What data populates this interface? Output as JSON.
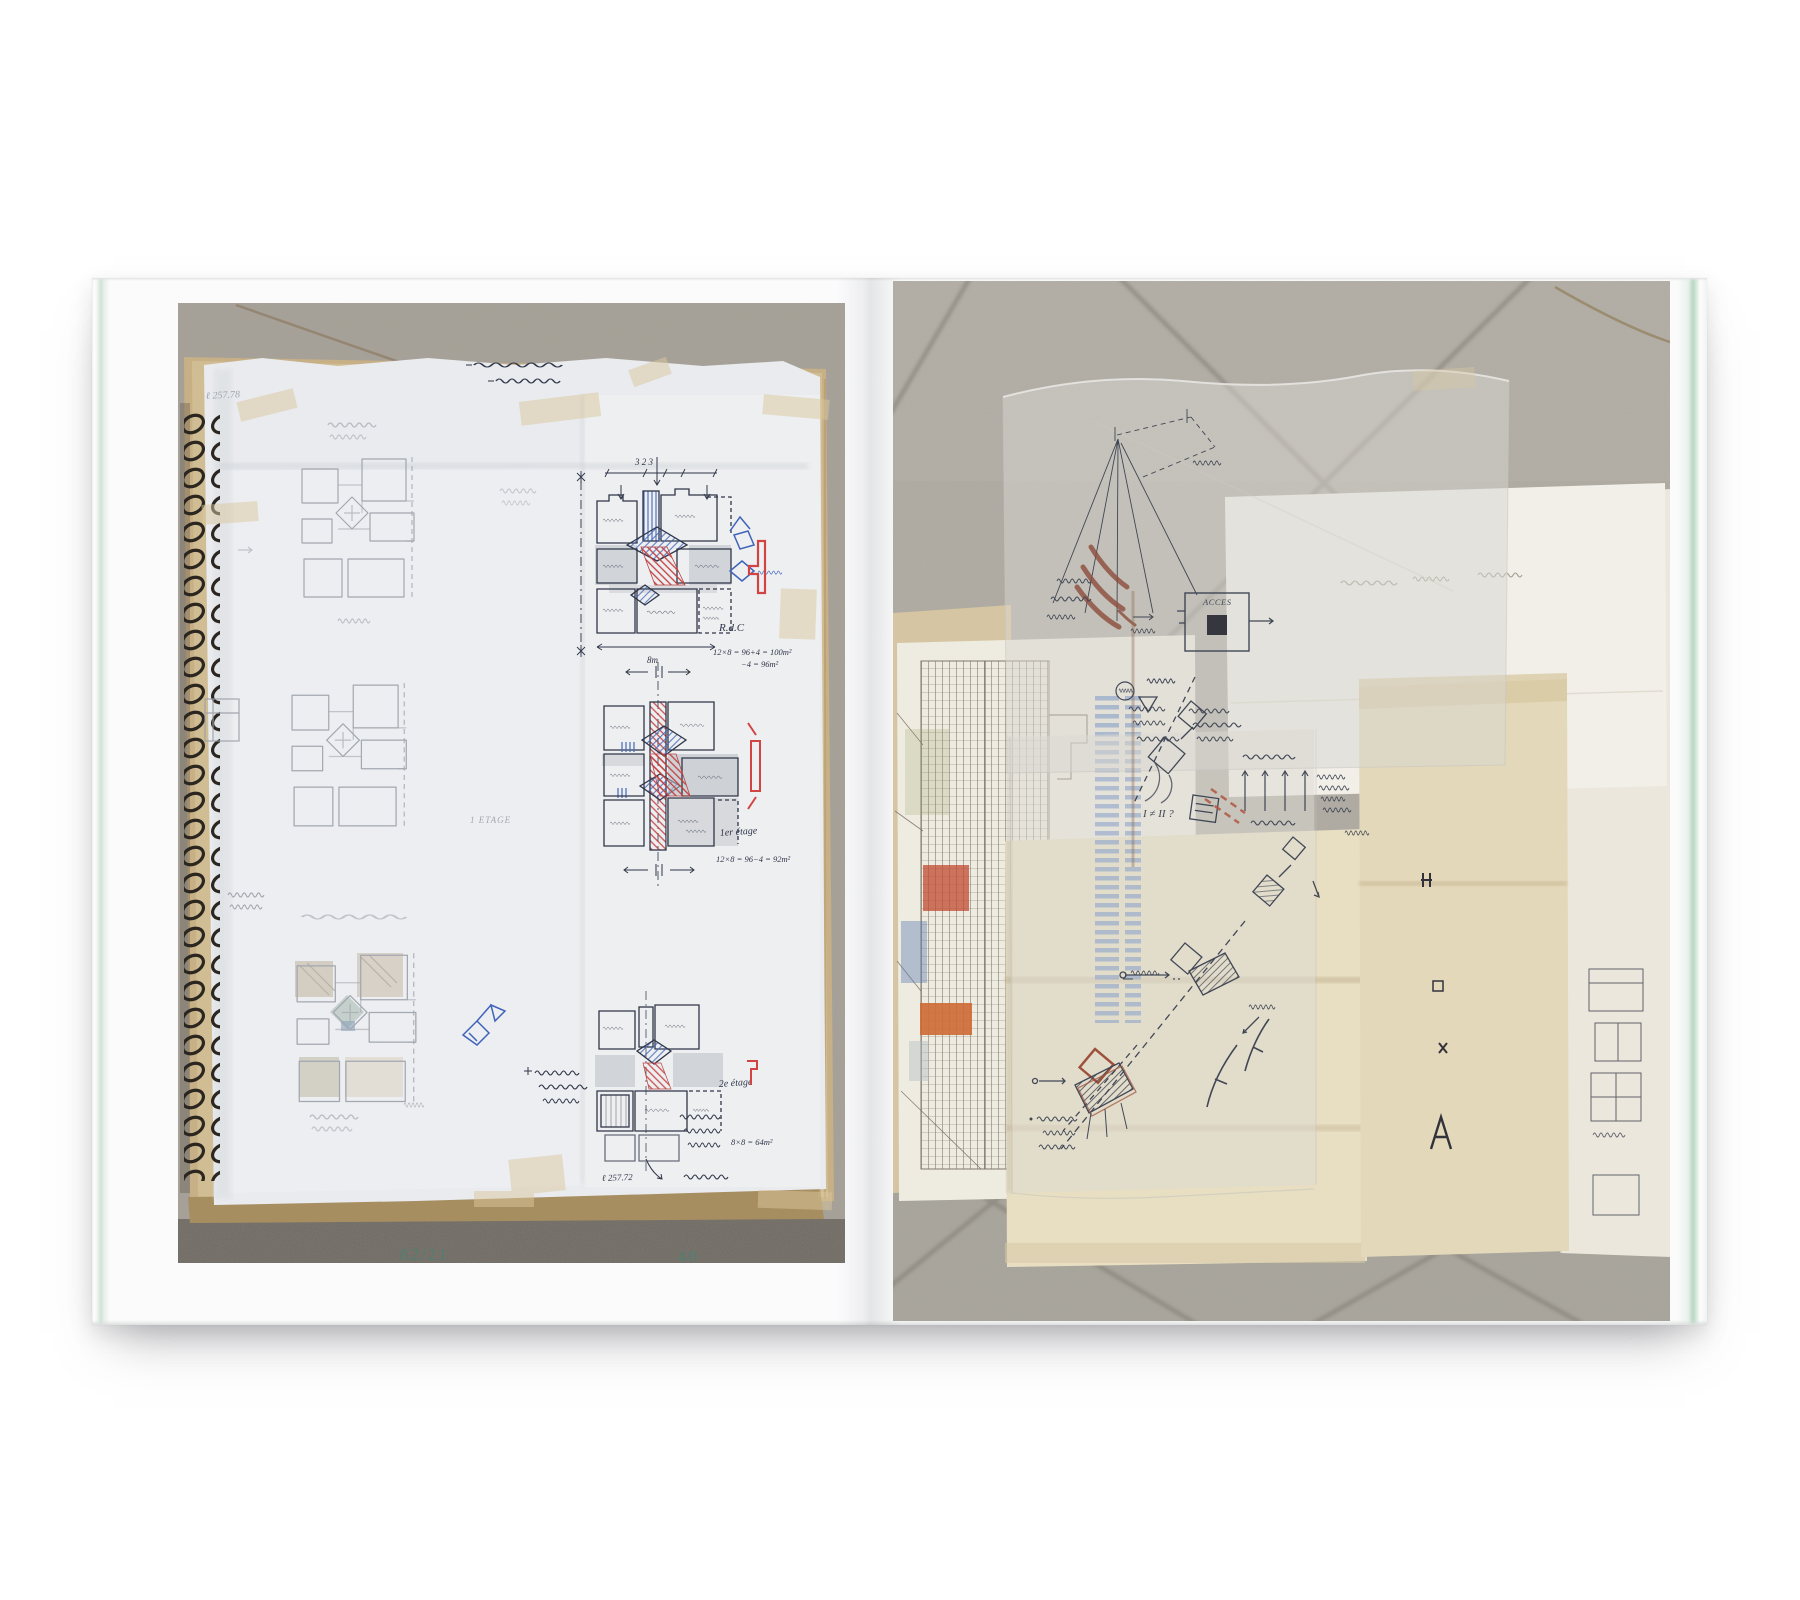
{
  "book": {
    "caption_left": "82/21",
    "page_number": "40"
  },
  "left_photo": {
    "annotations": {
      "ref_top": "ℓ 257.78",
      "dim_top": "3    2    3",
      "floor_ground": "R.d.C",
      "calc_ground_1": "12×8 = 96+4 = 100m²",
      "calc_ground_2": "−4 = 96m²",
      "dim_bottom": "8m",
      "floor_first": "1er étage",
      "calc_first": "12×8 = 96−4 = 92m²",
      "floor_first_pencil": "1 ETAGE",
      "floor_second": "2e étage",
      "calc_second": "8×8 = 64m²",
      "ref_bottom": "ℓ 257.72"
    }
  },
  "right_photo": {
    "annotations": {
      "access": "ACCES",
      "compare": "I ≠ II ?"
    }
  },
  "palette": {
    "caption_green": "#507f72",
    "edge_green": "#b8d7c4",
    "tile_gray_left": "#a8a39a",
    "tile_gray_right": "#b1ada5",
    "ink": "#2f3648",
    "pencil": "#9aa0a8",
    "accent_blue": "#4468bc",
    "accent_red": "#c23f3f",
    "marker_brown": "#8a4636"
  }
}
